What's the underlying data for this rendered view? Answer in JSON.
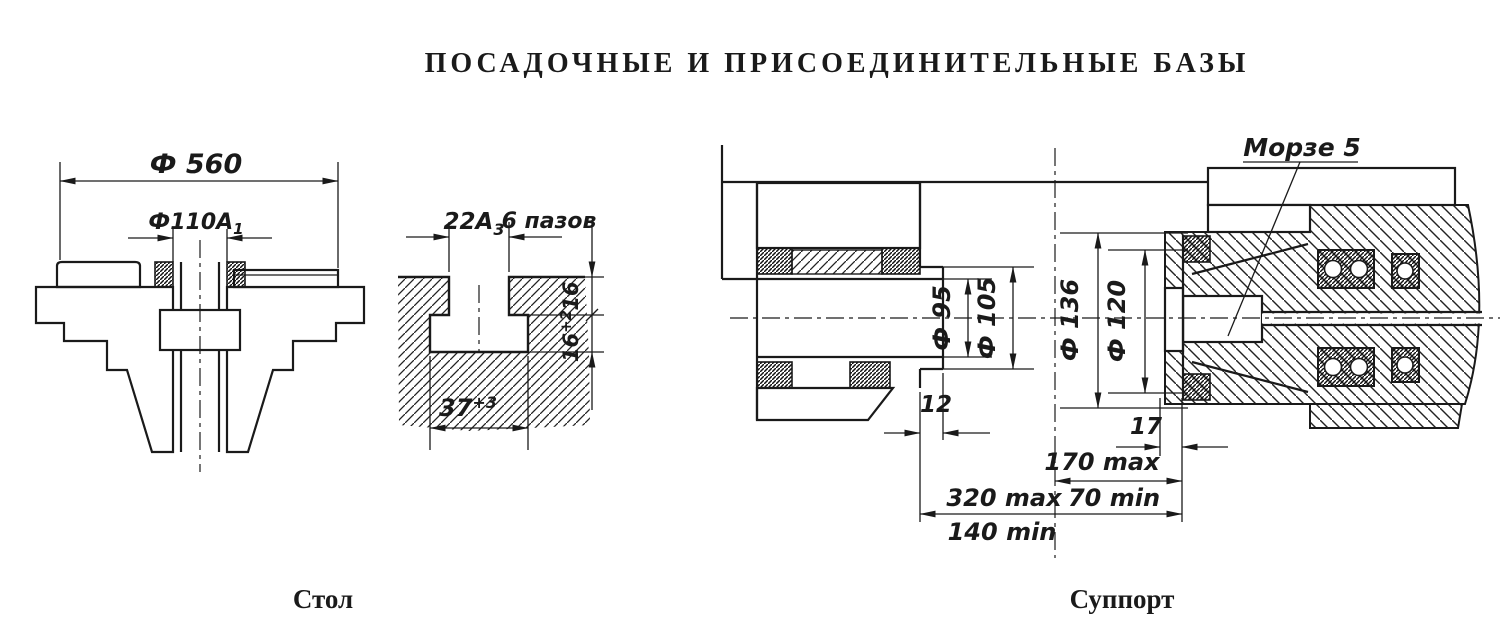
{
  "title": "ПОСАДОЧНЫЕ И ПРИСОЕДИНИТЕЛЬНЫЕ БАЗЫ",
  "colors": {
    "ink": "#1a1a1a",
    "paper": "#ffffff"
  },
  "table": {
    "caption": "Стол",
    "dim_560": "Ф 560",
    "dim_110_base": "Ф110А",
    "dim_110_sub": "1"
  },
  "tslot": {
    "dim_22_base": "22А",
    "dim_22_sub": "3",
    "slots_label": "6 пазов",
    "dim_16_upper": "16",
    "dim_16_lower_base": "16",
    "dim_16_lower_sup": "+2",
    "dim_37_base": "37",
    "dim_37_sup": "+3"
  },
  "support": {
    "caption": "Суппорт",
    "morse_label": "Морзе 5",
    "dim_d95": "Ф 95",
    "dim_d105": "Ф 105",
    "dim_d136": "Ф 136",
    "dim_d120": "Ф 120",
    "dim_12": "12",
    "dim_17": "17",
    "dim_170max": "170 max",
    "dim_70min": "70 min",
    "dim_320max": "320 max",
    "dim_140min": "140 min"
  }
}
